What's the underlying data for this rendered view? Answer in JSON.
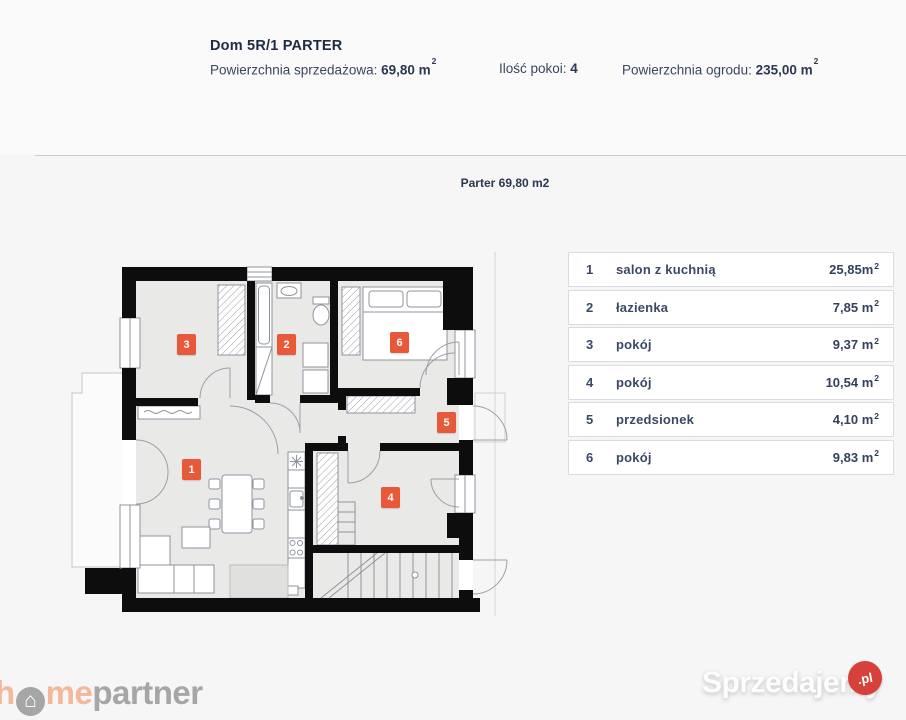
{
  "header": {
    "title": "Dom 5R/1 PARTER",
    "info": [
      {
        "label": "Powierzchnia sprzedażowa: ",
        "value": "69,80 m",
        "sup": "2"
      },
      {
        "label": "Ilość pokoi: ",
        "value": "4",
        "sup": ""
      },
      {
        "label": "Powierzchnia ogrodu: ",
        "value": "235,00 m",
        "sup": "2"
      }
    ]
  },
  "plan": {
    "caption": "Parter 69,80 m2",
    "markers": [
      "1",
      "2",
      "3",
      "4",
      "5",
      "6"
    ]
  },
  "legend": {
    "rows": [
      {
        "num": "1",
        "label": "salon z kuchnią",
        "area": "25,85m",
        "sup": "2"
      },
      {
        "num": "2",
        "label": "łazienka",
        "area": "7,85 m",
        "sup": "2"
      },
      {
        "num": "3",
        "label": "pokój",
        "area": "9,37 m",
        "sup": "2"
      },
      {
        "num": "4",
        "label": "pokój",
        "area": "10,54 m",
        "sup": "2"
      },
      {
        "num": "5",
        "label": "przedsionek",
        "area": "4,10 m",
        "sup": "2"
      },
      {
        "num": "6",
        "label": "pokój",
        "area": "9,83 m",
        "sup": "2"
      }
    ]
  },
  "footer": {
    "logo_h": "h",
    "logo_icon": "⌂",
    "logo_me": "me",
    "logo_partner": "partner",
    "watermark_text": "Sprzedajemy",
    "watermark_badge": ".pl"
  },
  "colors": {
    "accent_orange": "#e8593a",
    "wall_black": "#0d0d0d",
    "text_navy": "#37435e",
    "badge_red": "#d8403c"
  }
}
